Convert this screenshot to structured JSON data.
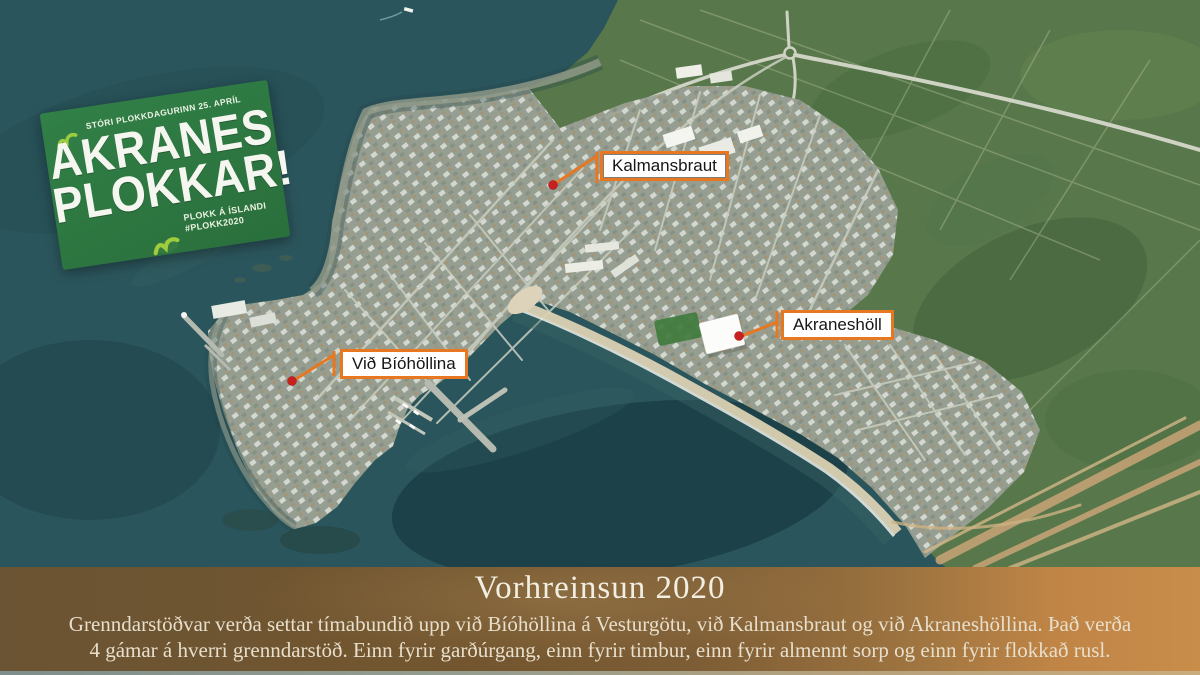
{
  "map": {
    "name": "aerial-map-akranes",
    "labels": [
      {
        "id": "kalmansbraut",
        "text": "Kalmansbraut"
      },
      {
        "id": "akraneshol",
        "text": "Akraneshöll"
      },
      {
        "id": "vid-biohollina",
        "text": "Við Bíóhöllina"
      }
    ],
    "marker_color": "#c81f1f",
    "leader_color": "#e87722"
  },
  "badge": {
    "tagline": "STÓRI PLOKKDAGURINN 25. APRÍL",
    "title_line1": "AKRANES",
    "title_line2": "PLOKKAR!",
    "footer_line1": "PLOKK Á ÍSLANDI",
    "footer_line2": "#PLOKK2020",
    "card_color": "#2e7a42",
    "accent_color": "#9fcb3e",
    "icon": "bird-check-icon"
  },
  "banner": {
    "title": "Vorhreinsun 2020",
    "body_lines": [
      "Grenndarstöðvar verða settar tímabundið upp við Bíóhöllina á Vesturgötu, við Kalmansbraut og við Akraneshöllina. Það verða",
      "4 gámar á hverri grenndarstöð. Einn fyrir garðúrgang, einn fyrir timbur, einn fyrir almennt sorp og einn fyrir flokkað rusl."
    ],
    "text_color": "#ece4d2",
    "background_left": "#6b5433",
    "background_right": "#c88c49"
  }
}
